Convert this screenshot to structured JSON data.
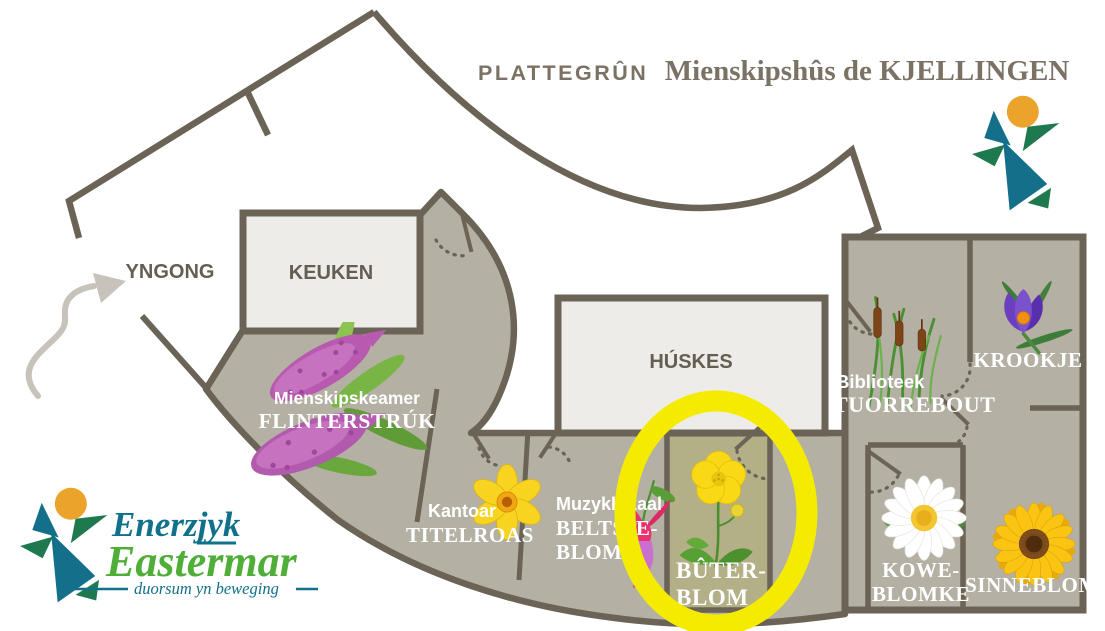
{
  "title": {
    "prefix": "PLATTEGRÛN",
    "name": "Mienskipshûs de KJELLINGEN"
  },
  "rooms": {
    "yngong": {
      "name": "YNGONG"
    },
    "keuken": {
      "name": "KEUKEN"
    },
    "huskes": {
      "name": "HÚSKES"
    },
    "flinterstruk": {
      "prefix": "Mienskipskeamer",
      "name": "FLINTERSTRÚK",
      "flower": "butterfly-bush"
    },
    "titelroas": {
      "prefix": "Kantoar",
      "name": "TITELROAS",
      "flower": "daffodil"
    },
    "beltsjeblom": {
      "prefix": "Muzyklokaal",
      "line1": "BELTSJE-",
      "line2": "BLOM",
      "flower": "fuchsia"
    },
    "buterblom": {
      "line1": "BÛTER-",
      "line2": "BLOM",
      "flower": "buttercup",
      "highlighted": true
    },
    "tuorrebout": {
      "prefix": "Biblioteek",
      "name": "TUORREBOUT",
      "flower": "cattail-reed"
    },
    "krookje": {
      "name": "KROOKJE",
      "flower": "crocus"
    },
    "koweblomke": {
      "line1": "KOWE-",
      "line2": "BLOMKE",
      "flower": "daisy"
    },
    "sinneblom": {
      "name": "SINNEBLOM",
      "flower": "sunflower"
    }
  },
  "logo": {
    "line1": "Enerzjyk",
    "line2": "Eastermar",
    "tagline": "duorsum yn beweging"
  },
  "colors": {
    "wall": "#6a6356",
    "floor": "#b4b0a3",
    "room_fill": "#edece8",
    "highlight_ring": "#f4eb00",
    "highlight_floor": "#b3af86",
    "title_text": "#7b7265",
    "logo_teal": "#11708a",
    "logo_green": "#4fae37",
    "logo_orange": "#eca32b"
  }
}
